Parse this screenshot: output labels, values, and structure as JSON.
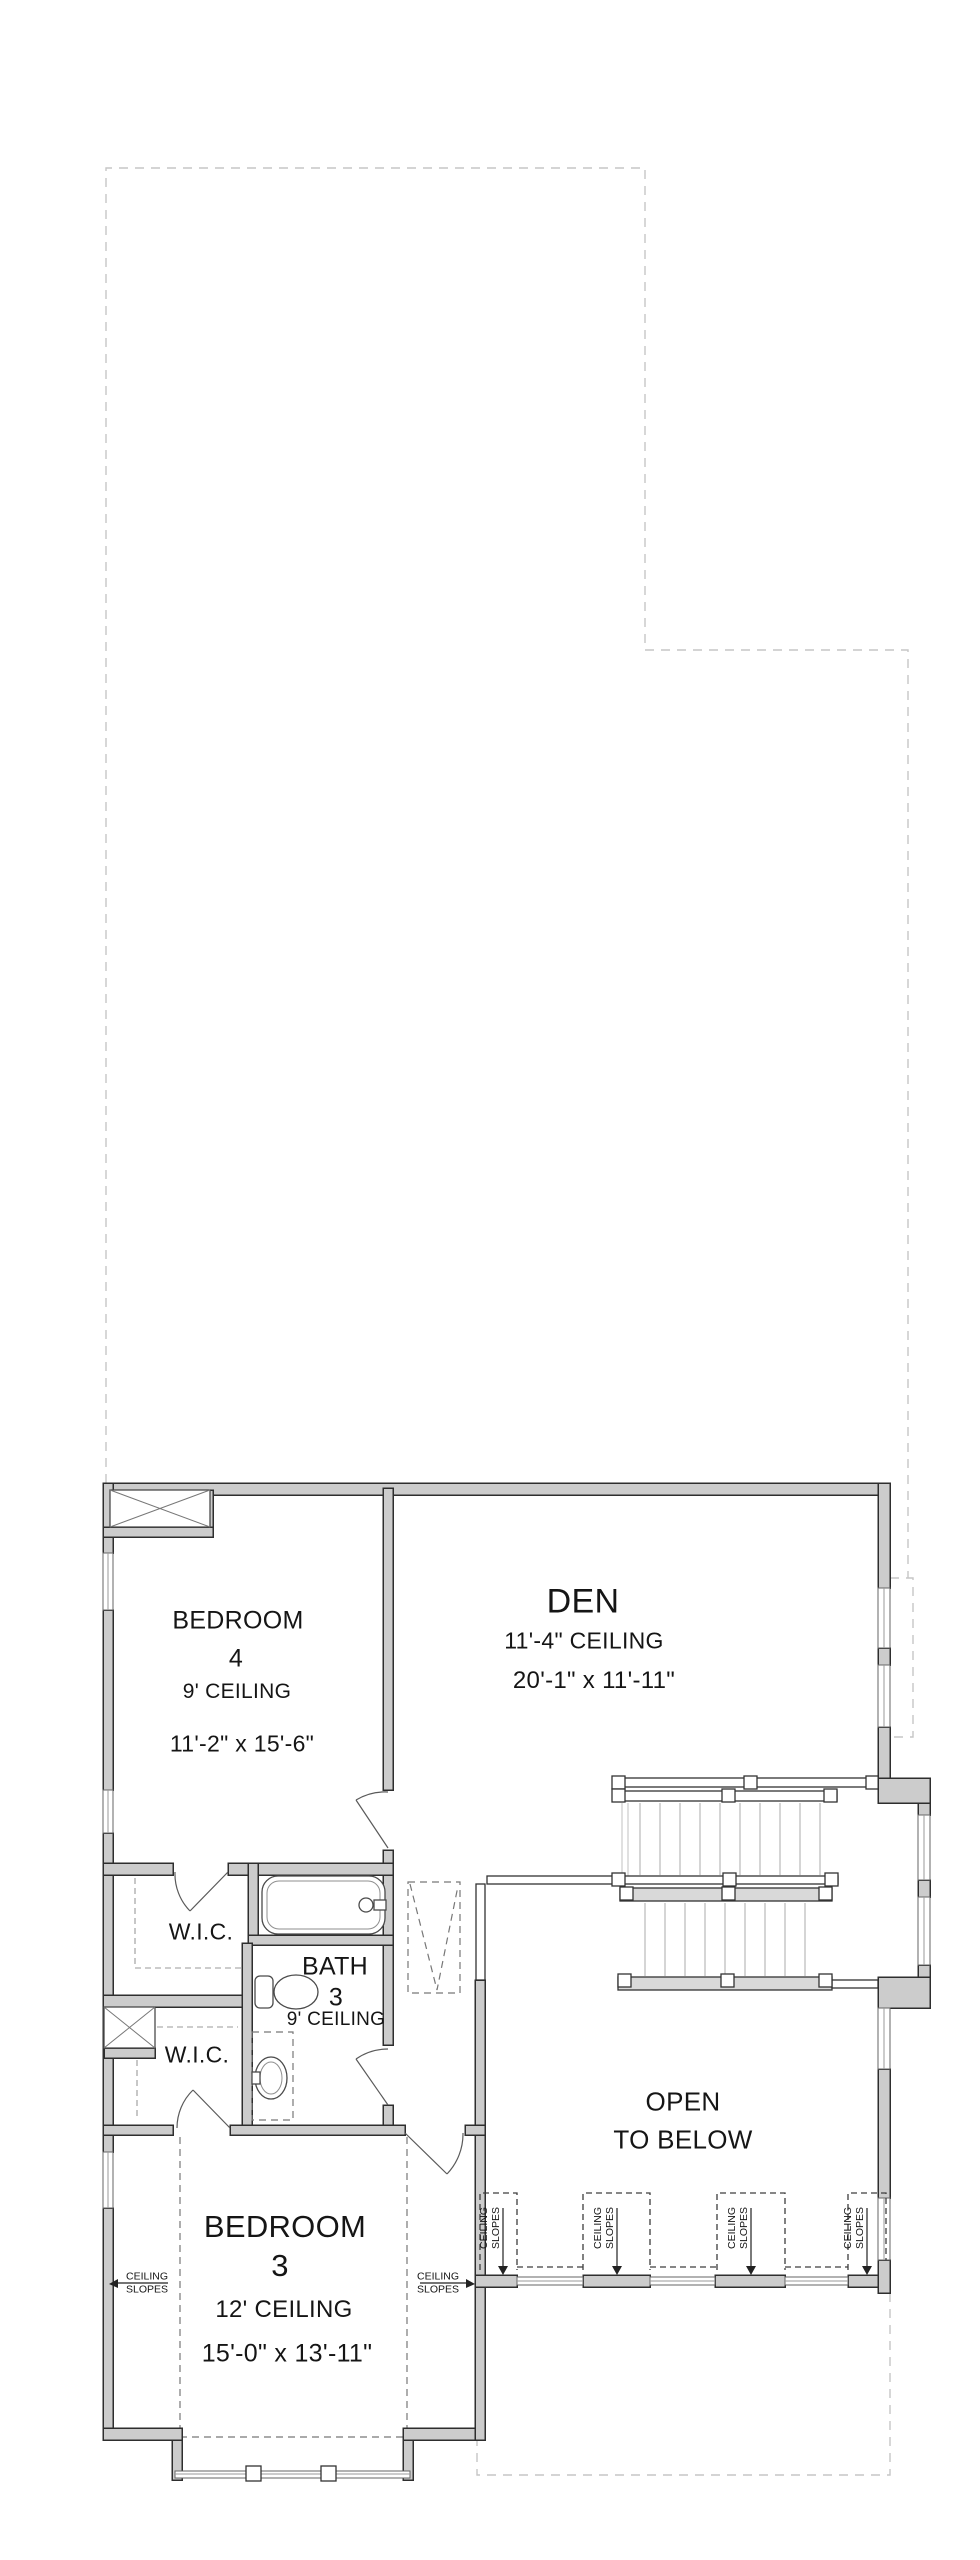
{
  "colors": {
    "wall_fill": "#cccccc",
    "wall_stroke": "#2e2e2e",
    "dash_color": "#c6c6c6",
    "interior_dash": "#777777",
    "text_color": "#151515",
    "fixture_stroke": "#4a4a4a"
  },
  "rooms": {
    "bedroom4": {
      "name": "BEDROOM",
      "number": "4",
      "ceiling": "9' CEILING",
      "dims": "11'-2\" x 15'-6\""
    },
    "den": {
      "name": "DEN",
      "ceiling": "11'-4\" CEILING",
      "dims": "20'-1\" x 11'-11\""
    },
    "bath3": {
      "name": "BATH",
      "number": "3",
      "ceiling": "9' CEILING"
    },
    "bedroom3": {
      "name": "BEDROOM",
      "number": "3",
      "ceiling": "12' CEILING",
      "dims": "15'-0\" x 13'-11\""
    },
    "wic_upper": {
      "name": "W.I.C."
    },
    "wic_lower": {
      "name": "W.I.C."
    },
    "open_to_below": {
      "line1": "OPEN",
      "line2": "TO BELOW"
    }
  },
  "annotations": {
    "ceiling_slopes_left": {
      "line1": "CEILING",
      "line2": "SLOPES"
    },
    "ceiling_slopes_right": {
      "line1": "CEILING",
      "line2": "SLOPES"
    },
    "dormers": [
      {
        "line1": "CEILING",
        "line2": "SLOPES"
      },
      {
        "line1": "CEILING",
        "line2": "SLOPES"
      },
      {
        "line1": "CEILING",
        "line2": "SLOPES"
      },
      {
        "line1": "CEILING",
        "line2": "SLOPES"
      }
    ]
  },
  "icons": {
    "bathtub": "bathtub-icon",
    "toilet": "toilet-icon",
    "sink": "sink-icon",
    "staircase": "staircase-icon",
    "attic_chase": "x-chase-icon"
  }
}
